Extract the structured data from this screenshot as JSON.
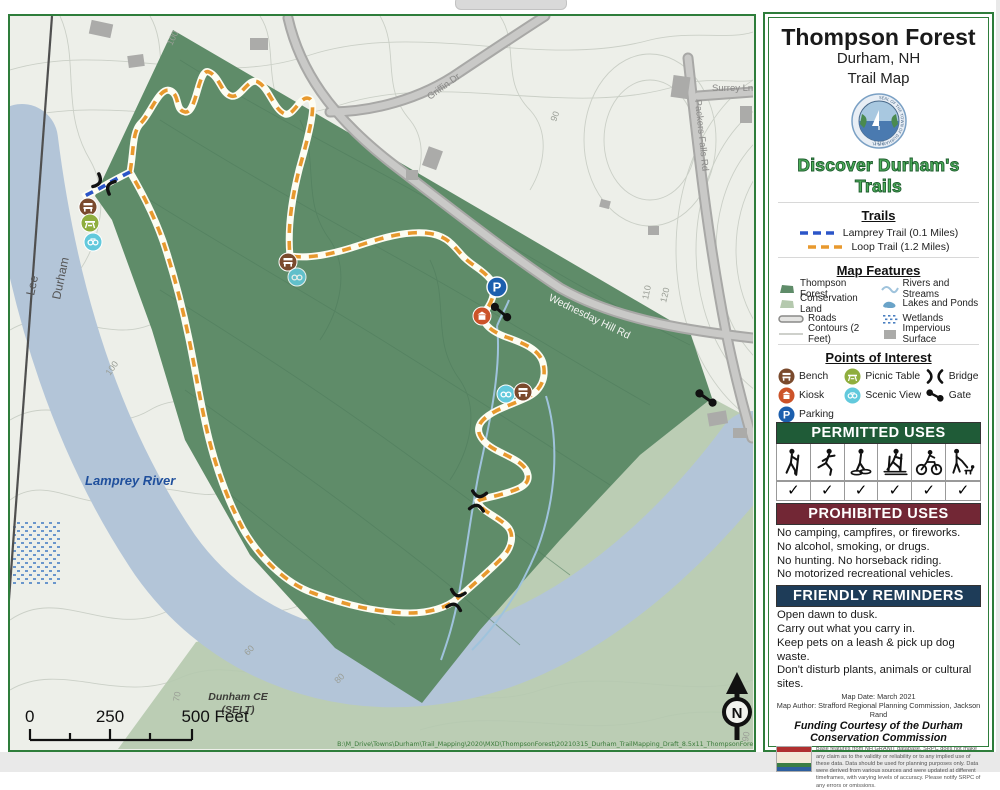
{
  "panel": {
    "title_line1": "Thompson Forest",
    "title_line2": "Durham, NH",
    "title_line3": "Trail Map",
    "seal_ring_text": "SEAL OF THE TOWN OF DURHAM N.H.",
    "seal_year": "1732",
    "tagline": "Discover Durham's Trails",
    "trails": {
      "heading": "Trails",
      "items": [
        {
          "label": "Lamprey Trail (0.1 Miles)",
          "color": "#2b55c8"
        },
        {
          "label": "Loop Trail (1.2 Miles)",
          "color": "#e8992e"
        }
      ]
    },
    "features": {
      "heading": "Map Features",
      "rows": [
        {
          "left": "Thompson Forest",
          "right": "Rivers and Streams"
        },
        {
          "left": "Conservation Land",
          "right": "Lakes and Ponds"
        },
        {
          "left": "Roads",
          "right": "Wetlands"
        },
        {
          "left": "Contours (2 Feet)",
          "right": "Impervious Surface"
        }
      ]
    },
    "poi": {
      "heading": "Points of Interest",
      "items": [
        "Bench",
        "Kiosk",
        "Parking",
        "Picnic Table",
        "Scenic View",
        "Bridge",
        "Gate"
      ]
    },
    "permitted": {
      "heading": "PERMITTED USES",
      "activities": [
        "hiking",
        "running",
        "snowshoeing",
        "cross-country skiing",
        "biking",
        "dog walking"
      ],
      "check": "✓"
    },
    "prohibited": {
      "heading": "PROHIBITED USES",
      "lines": [
        "No camping, campfires, or fireworks.",
        "No alcohol, smoking, or drugs.",
        "No hunting. No horseback riding.",
        "No motorized recreational vehicles."
      ]
    },
    "reminders": {
      "heading": "FRIENDLY REMINDERS",
      "lines": [
        "Open dawn to dusk.",
        "Carry out what you carry in.",
        "Keep pets on a leash & pick up dog waste.",
        "Don't disturb plants, animals or cultural sites."
      ]
    },
    "credits": {
      "map_date": "Map Date: March 2021",
      "map_author": "Map Author: Strafford Regional Planning Commission, Jackson Rand",
      "funding": "Funding Courtesy of the Durham Conservation Commission",
      "disclaimer": "Base features from NH GRANIT database. SRPC does not make any claim as to the validity or reliability or to any implied use of these data. Data should be used for planning purposes only. Data were derived from various sources and were updated at different timeframes, with varying levels of accuracy. Please notify SRPC of any errors or omissions."
    }
  },
  "map": {
    "labels": {
      "town_left": "Lee",
      "town_right": "Durham",
      "river": "Lamprey River",
      "road_griffin": "Griffin Dr",
      "road_surrey": "Surrey Ln",
      "road_packers": "Packers Falls Rd",
      "road_wednesday": "Wednesday Hill Rd",
      "conservation_line1": "Dunham CE",
      "conservation_line2": "(SELT)"
    },
    "contour_labels": [
      "100",
      "90",
      "100",
      "110",
      "120",
      "60",
      "70",
      "80",
      "90"
    ],
    "scale": {
      "tick0": "0",
      "tick1": "250",
      "tick2": "500 Feet"
    },
    "north_letter": "N",
    "attribution": "B:\\M_Drive\\Towns\\Durham\\Trail_Mapping\\2020\\MXD\\ThompsonForest\\20210315_Durham_TrailMapping_Draft_8.5x11_ThompsonForest.mxd"
  },
  "colors": {
    "forest": "#5f8c69",
    "conservation": "#b5c9ae",
    "water": "#b3c5d8",
    "loop_trail": "#e8992e",
    "lamprey_trail": "#2b55c8",
    "permitted_bar": "#1f5b37",
    "prohibited_bar": "#722735",
    "reminders_bar": "#1e3c58",
    "panel_border": "#2e7d3b"
  }
}
